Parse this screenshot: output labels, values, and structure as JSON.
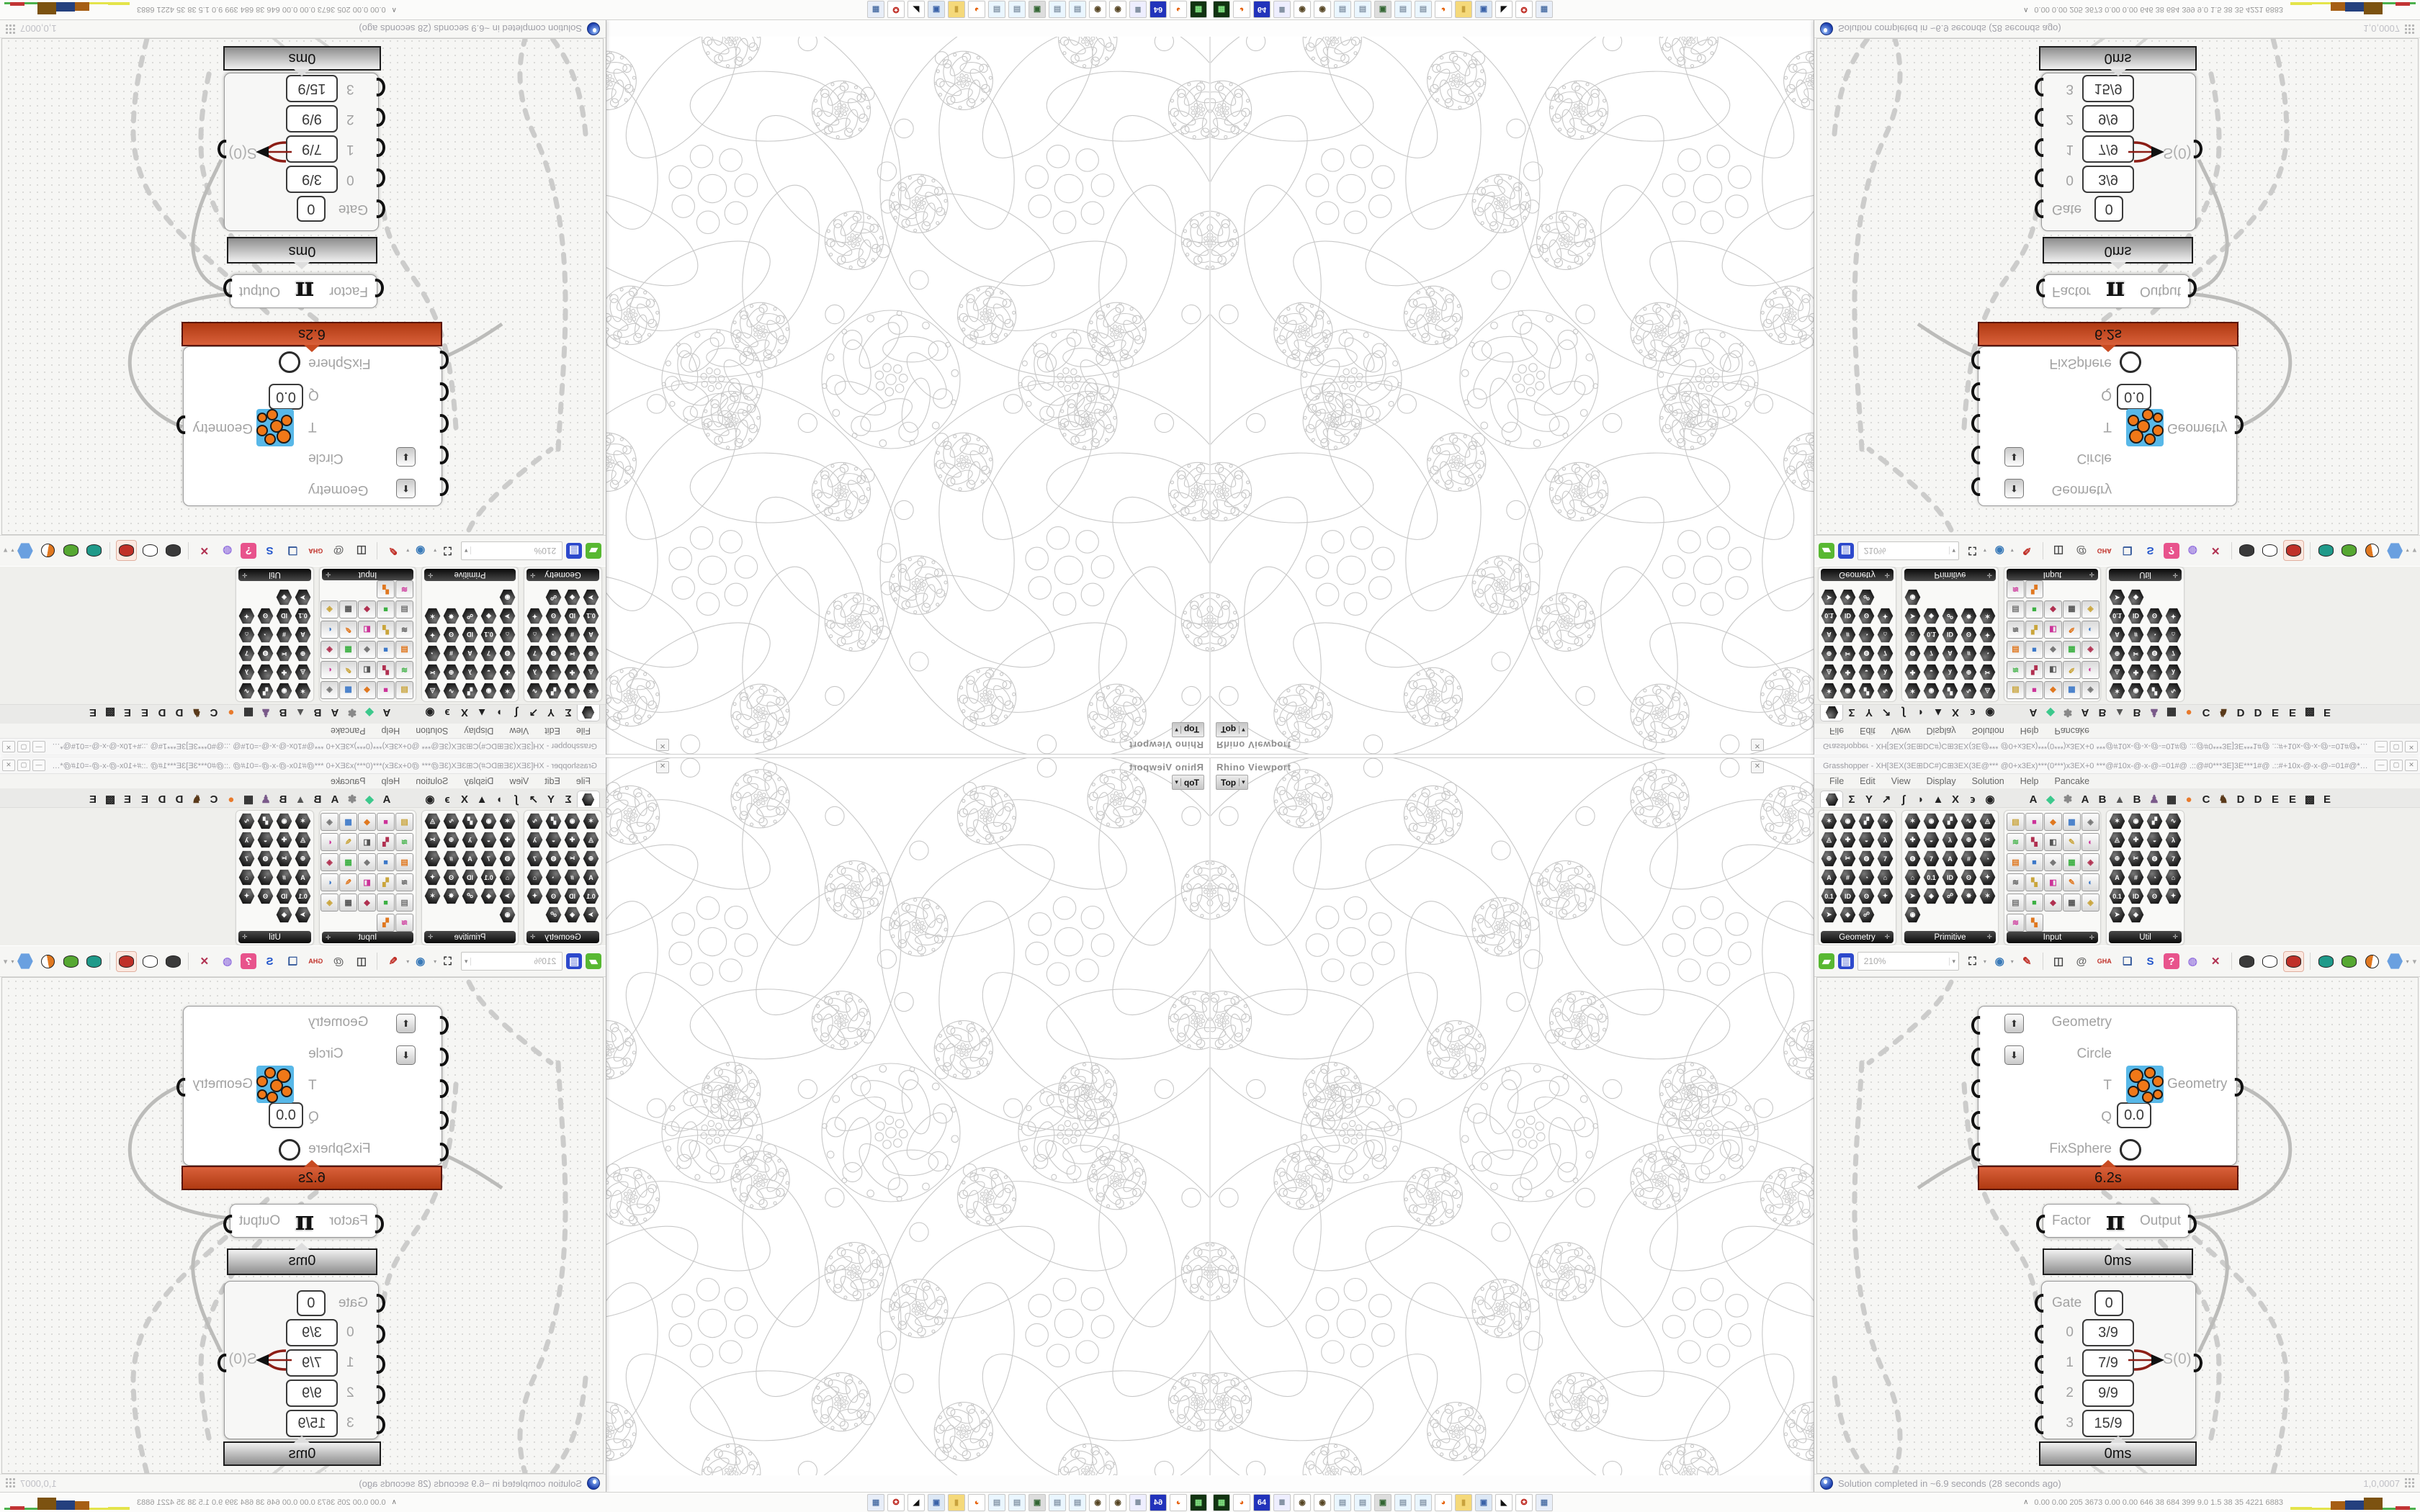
{
  "viewport": {
    "panel_title": "Rhino Viewport",
    "tab_label": "Top",
    "close_glyph": "✕"
  },
  "window": {
    "title": "Grasshopper - XH[3EX(3E⊞DC#)C⊞3EX(3E@*** @0+x3Ex)***(0***)x3EX+0 ***@#10x-@-x-@-=01#@ .::@#0***3E]3E***1#@ .::#+10x-@-x-@-=01#@***@0+x3Ex***0***...",
    "buttons": [
      "—",
      "▢",
      "✕"
    ]
  },
  "menus": [
    "File",
    "Edit",
    "View",
    "Display",
    "Solution",
    "Help",
    "Pancake"
  ],
  "tabs": [
    {
      "name": "tab-params",
      "glyph": "hex",
      "selected": true
    },
    {
      "name": "tab-maths",
      "glyph": "Σ"
    },
    {
      "name": "tab-sets",
      "glyph": "Y"
    },
    {
      "name": "tab-vector",
      "glyph": "↗"
    },
    {
      "name": "tab-curve",
      "glyph": "∫"
    },
    {
      "name": "tab-surface",
      "glyph": "◗"
    },
    {
      "name": "tab-mesh",
      "glyph": "▲"
    },
    {
      "name": "tab-intersect",
      "glyph": "X"
    },
    {
      "name": "tab-transform",
      "glyph": "϶"
    },
    {
      "name": "tab-display",
      "glyph": "◉"
    },
    {
      "name": "tab-plugin-a1",
      "glyph": "A",
      "gap": true
    },
    {
      "name": "tab-plugin-gem",
      "glyph": "◆",
      "color": "#3cc88c"
    },
    {
      "name": "tab-plugin-flower",
      "glyph": "✽",
      "color": "#888"
    },
    {
      "name": "tab-plugin-a2",
      "glyph": "A"
    },
    {
      "name": "tab-plugin-b1",
      "glyph": "B"
    },
    {
      "name": "tab-plugin-mountain",
      "glyph": "▲",
      "color": "#555"
    },
    {
      "name": "tab-plugin-b2",
      "glyph": "B"
    },
    {
      "name": "tab-plugin-puppet",
      "glyph": "♟",
      "color": "#7a5a8a"
    },
    {
      "name": "tab-plugin-grid",
      "glyph": "▦"
    },
    {
      "name": "tab-plugin-orange",
      "glyph": "●",
      "color": "#e87a2c"
    },
    {
      "name": "tab-plugin-c",
      "glyph": "C"
    },
    {
      "name": "tab-plugin-bird",
      "glyph": "♞",
      "color": "#5a3a1a"
    },
    {
      "name": "tab-plugin-d1",
      "glyph": "D"
    },
    {
      "name": "tab-plugin-d2",
      "glyph": "D"
    },
    {
      "name": "tab-plugin-e1",
      "glyph": "E"
    },
    {
      "name": "tab-plugin-e2",
      "glyph": "E"
    },
    {
      "name": "tab-plugin-dotgrid",
      "glyph": "▩"
    },
    {
      "name": "tab-plugin-e3",
      "glyph": "E"
    }
  ],
  "ribbon": {
    "groups": [
      {
        "label": "Geometry",
        "cols": 4,
        "count": 23,
        "style": "hex"
      },
      {
        "label": "Primitive",
        "cols": 5,
        "count": 26,
        "style": "hex"
      },
      {
        "label": "Input",
        "cols": 5,
        "count": 27,
        "style": "square"
      },
      {
        "label": "Util",
        "cols": 4,
        "count": 22,
        "style": "hex"
      }
    ],
    "expand_glyph": "✛",
    "hex_glyphs": [
      "✶",
      "◉",
      "▞",
      "∿",
      "◬",
      "✚",
      "◒",
      "λ",
      "⊕",
      "✂",
      "◍",
      "7",
      "A",
      "#",
      "◔",
      "⌂",
      "0.1",
      "ID",
      "ʘ",
      "✦",
      "➤",
      "◈",
      "☍",
      "✸"
    ],
    "square_glyphs": [
      "▤",
      "■",
      "◆",
      "▦",
      "◈",
      "≋",
      "▚",
      "◧",
      "✎",
      "◐"
    ],
    "square_colors": [
      "#caa53c",
      "#cc3399",
      "#e07820",
      "#3c78c8",
      "#777777",
      "#3cb043",
      "#b03050",
      "#555555"
    ]
  },
  "toolbar": {
    "zoom_value": "210%",
    "items": [
      {
        "name": "open-file-button",
        "glyph": "▰",
        "bg": "#58b832",
        "fg": "#ffffff"
      },
      {
        "name": "save-file-button",
        "glyph": "▤",
        "bg": "#2d49cc",
        "fg": "#ffffff"
      },
      {
        "name": "zoom-field",
        "field": true
      },
      {
        "name": "zoom-extents-button",
        "glyph": "⛶",
        "fg": "#222222",
        "dd": true
      },
      {
        "name": "preview-eye-button",
        "glyph": "◉",
        "fg": "#3a7ab8",
        "dd": true
      },
      {
        "name": "sketch-pen-button",
        "glyph": "✎",
        "fg": "#c03028"
      },
      {
        "sep": true
      },
      {
        "name": "remote-control-button",
        "glyph": "◫",
        "fg": "#444444"
      },
      {
        "name": "publish-at-button",
        "glyph": "@",
        "fg": "#666666"
      },
      {
        "name": "gha-button",
        "glyph": "GHA",
        "fg": "#c03028",
        "small": true
      },
      {
        "name": "screenshot-button",
        "glyph": "❏",
        "fg": "#33589a"
      },
      {
        "name": "find-button",
        "glyph": "S",
        "fg": "#2255cc"
      },
      {
        "name": "package-help-button",
        "glyph": "?",
        "bg": "#e8538c",
        "fg": "#ffffff"
      },
      {
        "name": "idea-bulb-button",
        "glyph": "◍",
        "fg": "#9a7ae0"
      },
      {
        "name": "wire-display-button",
        "glyph": "✕",
        "fg": "#b03050"
      },
      {
        "sep": true
      },
      {
        "name": "preview-off-button",
        "cyl": "#3a3a3a"
      },
      {
        "name": "preview-wireframe-button",
        "cyl": "#ffffff"
      },
      {
        "name": "preview-shaded-button",
        "cyl": "#c03028",
        "selected": true
      },
      {
        "sep": true
      },
      {
        "name": "bake-teal-button",
        "cyl": "#1f9a8a"
      },
      {
        "name": "bake-green-button",
        "cyl": "#56a832"
      },
      {
        "name": "material-sphere-button",
        "ball": "#e07820"
      },
      {
        "name": "display-hexagon-button",
        "hexc": "#6aa0e0",
        "dd": true
      }
    ],
    "collapse_glyph": "▾"
  },
  "components": {
    "fixsphere": {
      "inputs": [
        "Geometry",
        "Circle",
        "T",
        "Q",
        "FixSphere"
      ],
      "q_value": "0.0",
      "output_label": "Geometry",
      "runtime": "6.2s",
      "up_glyph": "⬆",
      "down_glyph": "⬇"
    },
    "pi": {
      "input_label": "Factor",
      "symbol": "π",
      "output_label": "Output",
      "runtime": "0ms"
    },
    "gate": {
      "gate_label": "Gate",
      "gate_value": "0",
      "rows": [
        {
          "index": "0",
          "value": "3/9"
        },
        {
          "index": "1",
          "value": "7/9"
        },
        {
          "index": "2",
          "value": "9/9"
        },
        {
          "index": "3",
          "value": "15/9"
        }
      ],
      "output_label": "S(0)",
      "runtime": "0ms"
    }
  },
  "status": {
    "text": "Solution completed in ~6.9 seconds (28 seconds ago)",
    "version": "1,0,0007"
  },
  "taskbar": {
    "caret": "∧",
    "stats": "0.00 0.00 205 3673 0.00 0.00 646  38  684 399  9.0  1.5  38  35  4221 6883",
    "icons": [
      {
        "name": "console-app-icon",
        "g": "▦",
        "bg": "#123312",
        "fg": "#7fe07f"
      },
      {
        "name": "firefox-icon",
        "g": "◕",
        "bg": "#ffffff",
        "fg": "#e66000"
      },
      {
        "name": "floppy64-icon",
        "g": "64",
        "bg": "#2233bb",
        "fg": "#ffffff"
      },
      {
        "name": "script-doc-icon",
        "g": "≣",
        "bg": "#eeeeff",
        "fg": "#667788"
      },
      {
        "name": "seal-icon",
        "g": "◉",
        "bg": "#ffffff",
        "fg": "#554422"
      },
      {
        "name": "seal2-icon",
        "g": "◉",
        "bg": "#ffffff",
        "fg": "#554422"
      },
      {
        "name": "notepad-icon",
        "g": "▤",
        "bg": "#eaf6ff",
        "fg": "#8899aa"
      },
      {
        "name": "notepad2-icon",
        "g": "▤",
        "bg": "#eaf6ff",
        "fg": "#8899aa"
      },
      {
        "name": "computer-icon",
        "g": "▣",
        "bg": "#dddddd",
        "fg": "#336633"
      },
      {
        "name": "notepad3-icon",
        "g": "▤",
        "bg": "#eaf6ff",
        "fg": "#8899aa"
      },
      {
        "name": "notepad4-icon",
        "g": "▤",
        "bg": "#eaf6ff",
        "fg": "#8899aa"
      },
      {
        "name": "firefox2-icon",
        "g": "◕",
        "bg": "#ffffff",
        "fg": "#e66000"
      },
      {
        "name": "folder-icon",
        "g": "▮",
        "bg": "#f5d97a",
        "fg": "#c8a23c"
      },
      {
        "name": "monitor-icon",
        "g": "▣",
        "bg": "#dde8f5",
        "fg": "#3a62a8"
      },
      {
        "name": "arrow-app-icon",
        "g": "◣",
        "bg": "#ffffff",
        "fg": "#111111"
      },
      {
        "name": "red-badge-icon",
        "g": "✪",
        "bg": "#ffffff",
        "fg": "#c03028"
      },
      {
        "name": "calculator-icon",
        "g": "▦",
        "bg": "#e8eef8",
        "fg": "#5577aa"
      }
    ],
    "chart": [
      {
        "c": "#e4e44a",
        "w": 30,
        "h": 4
      },
      {
        "c": "#e4e44a",
        "w": 26,
        "h": 3
      },
      {
        "c": "#a65e14",
        "w": 20,
        "h": 12
      },
      {
        "c": "#24407e",
        "w": 26,
        "h": 13
      },
      {
        "c": "#7c5210",
        "w": 26,
        "h": 17
      },
      {
        "c": "#4cb04c",
        "w": 18,
        "h": 3
      },
      {
        "c": "#c23434",
        "w": 20,
        "h": 5
      },
      {
        "c": "#4cb04c",
        "w": 8,
        "h": 3
      }
    ]
  },
  "colors": {
    "runtime_hot": "#c84b22",
    "runtime_gray": "#bdbdbd",
    "wire": "#cccccb",
    "red_wire": "#8c1d15",
    "fractal_stroke": "#c8c8c8"
  }
}
